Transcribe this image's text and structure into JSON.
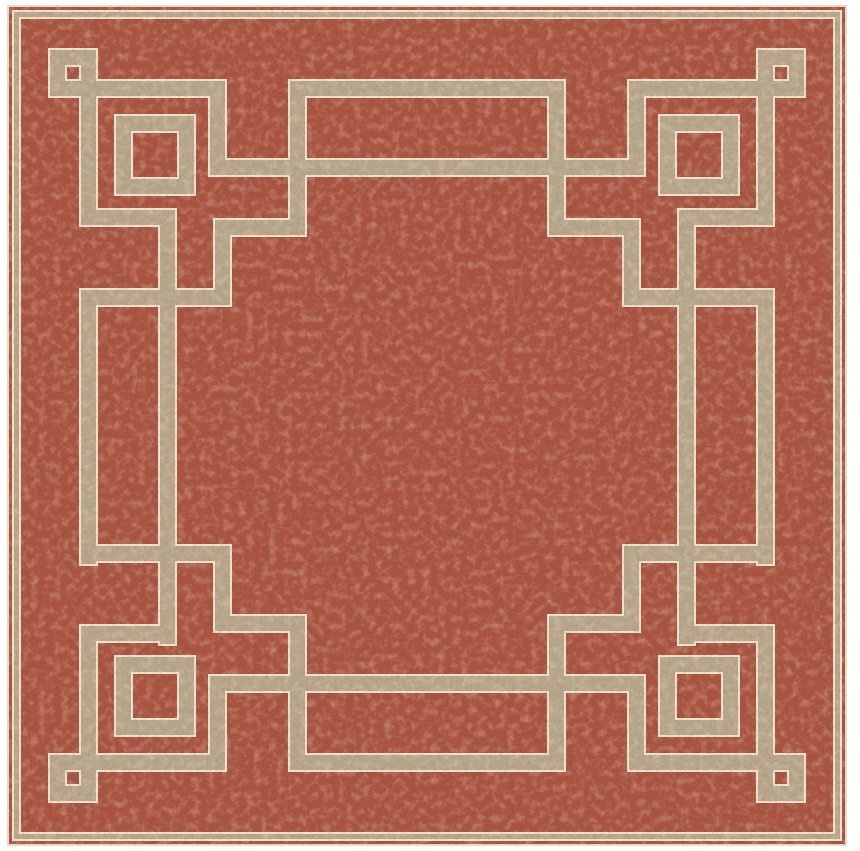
{
  "scene": {
    "type": "product-photo",
    "subject": "square flatweave area rug",
    "pattern": "greek-key fretwork border with corner squares and mid-side rectangles",
    "field_texture": "heathered woven fabric",
    "background": "plain white"
  },
  "colors": {
    "page_background": "#ffffff",
    "rug_field": "#a6503d",
    "rug_field_dark_fleck": "#6f3224",
    "rug_field_light_fleck": "#d9a585",
    "pattern_band": "#b4a489",
    "band_edge_cream": "#ece3cd",
    "rug_binding_edge": "#e6dcc6"
  },
  "motifs": {
    "corner_small_square": "small open square knot at each of the 4 corners",
    "medium_square": "medium open square on each corner diagonal",
    "side_rectangle": "long open rectangle protruding outward at each mid-side",
    "pinstripe": "thin perimeter pinstripe just inside rug edge"
  }
}
